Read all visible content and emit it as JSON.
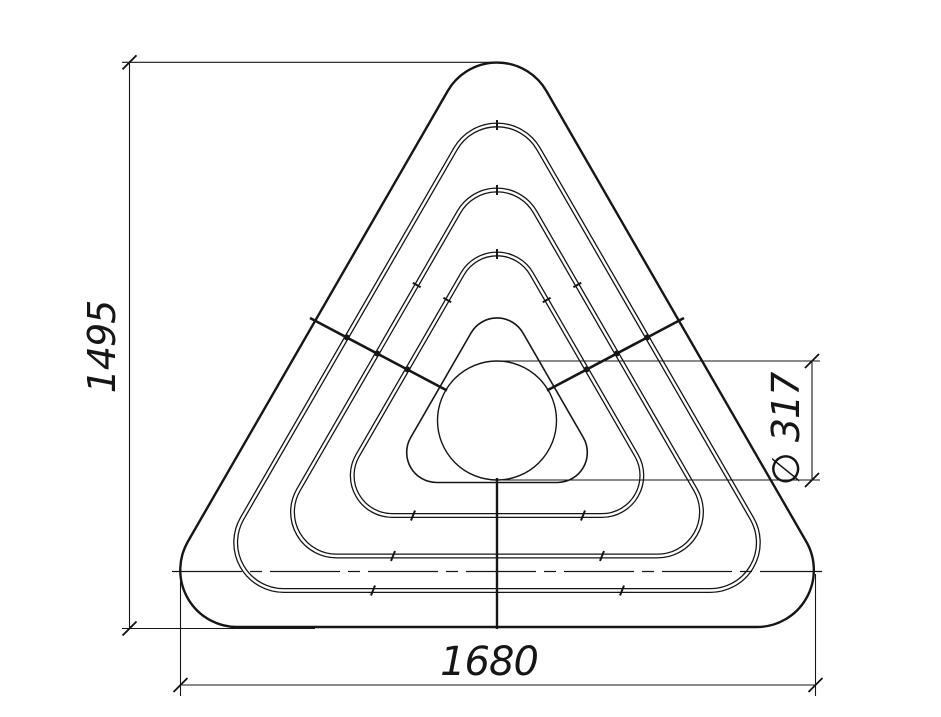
{
  "drawing": {
    "background_color": "#ffffff",
    "line_color": "#161616",
    "nested_triangle_count": 5,
    "dimensions": {
      "height": {
        "label": "1495"
      },
      "width": {
        "label": "1680"
      },
      "diameter": {
        "label": "∅ 317"
      }
    }
  }
}
